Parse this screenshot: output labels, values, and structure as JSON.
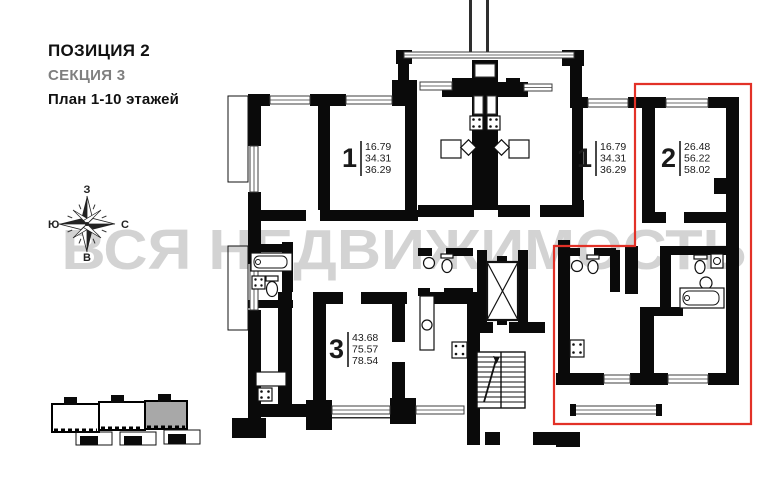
{
  "header": {
    "position": "ПОЗИЦИЯ 2",
    "section": "СЕКЦИЯ 3",
    "plan_floors": "План 1-10 этажей"
  },
  "compass": {
    "top": "З",
    "right": "С",
    "bottom": "В",
    "left": "Ю"
  },
  "watermark": {
    "text": "ВСЯ НЕДВИЖИМОСТЬ",
    "color": "#c9c9c9"
  },
  "apartments": [
    {
      "number": "1",
      "areas": [
        "16.79",
        "34.31",
        "36.29"
      ]
    },
    {
      "number": "1",
      "areas": [
        "16.79",
        "34.31",
        "36.29"
      ]
    },
    {
      "number": "2",
      "areas": [
        "26.48",
        "56.22",
        "58.02"
      ]
    },
    {
      "number": "3",
      "areas": [
        "43.68",
        "75.57",
        "78.54"
      ]
    }
  ],
  "highlight": {
    "color": "#e23127"
  },
  "site_plan": {
    "sections": "3",
    "highlighted_section": "3",
    "highlight_fill": "#a8a8a8"
  }
}
